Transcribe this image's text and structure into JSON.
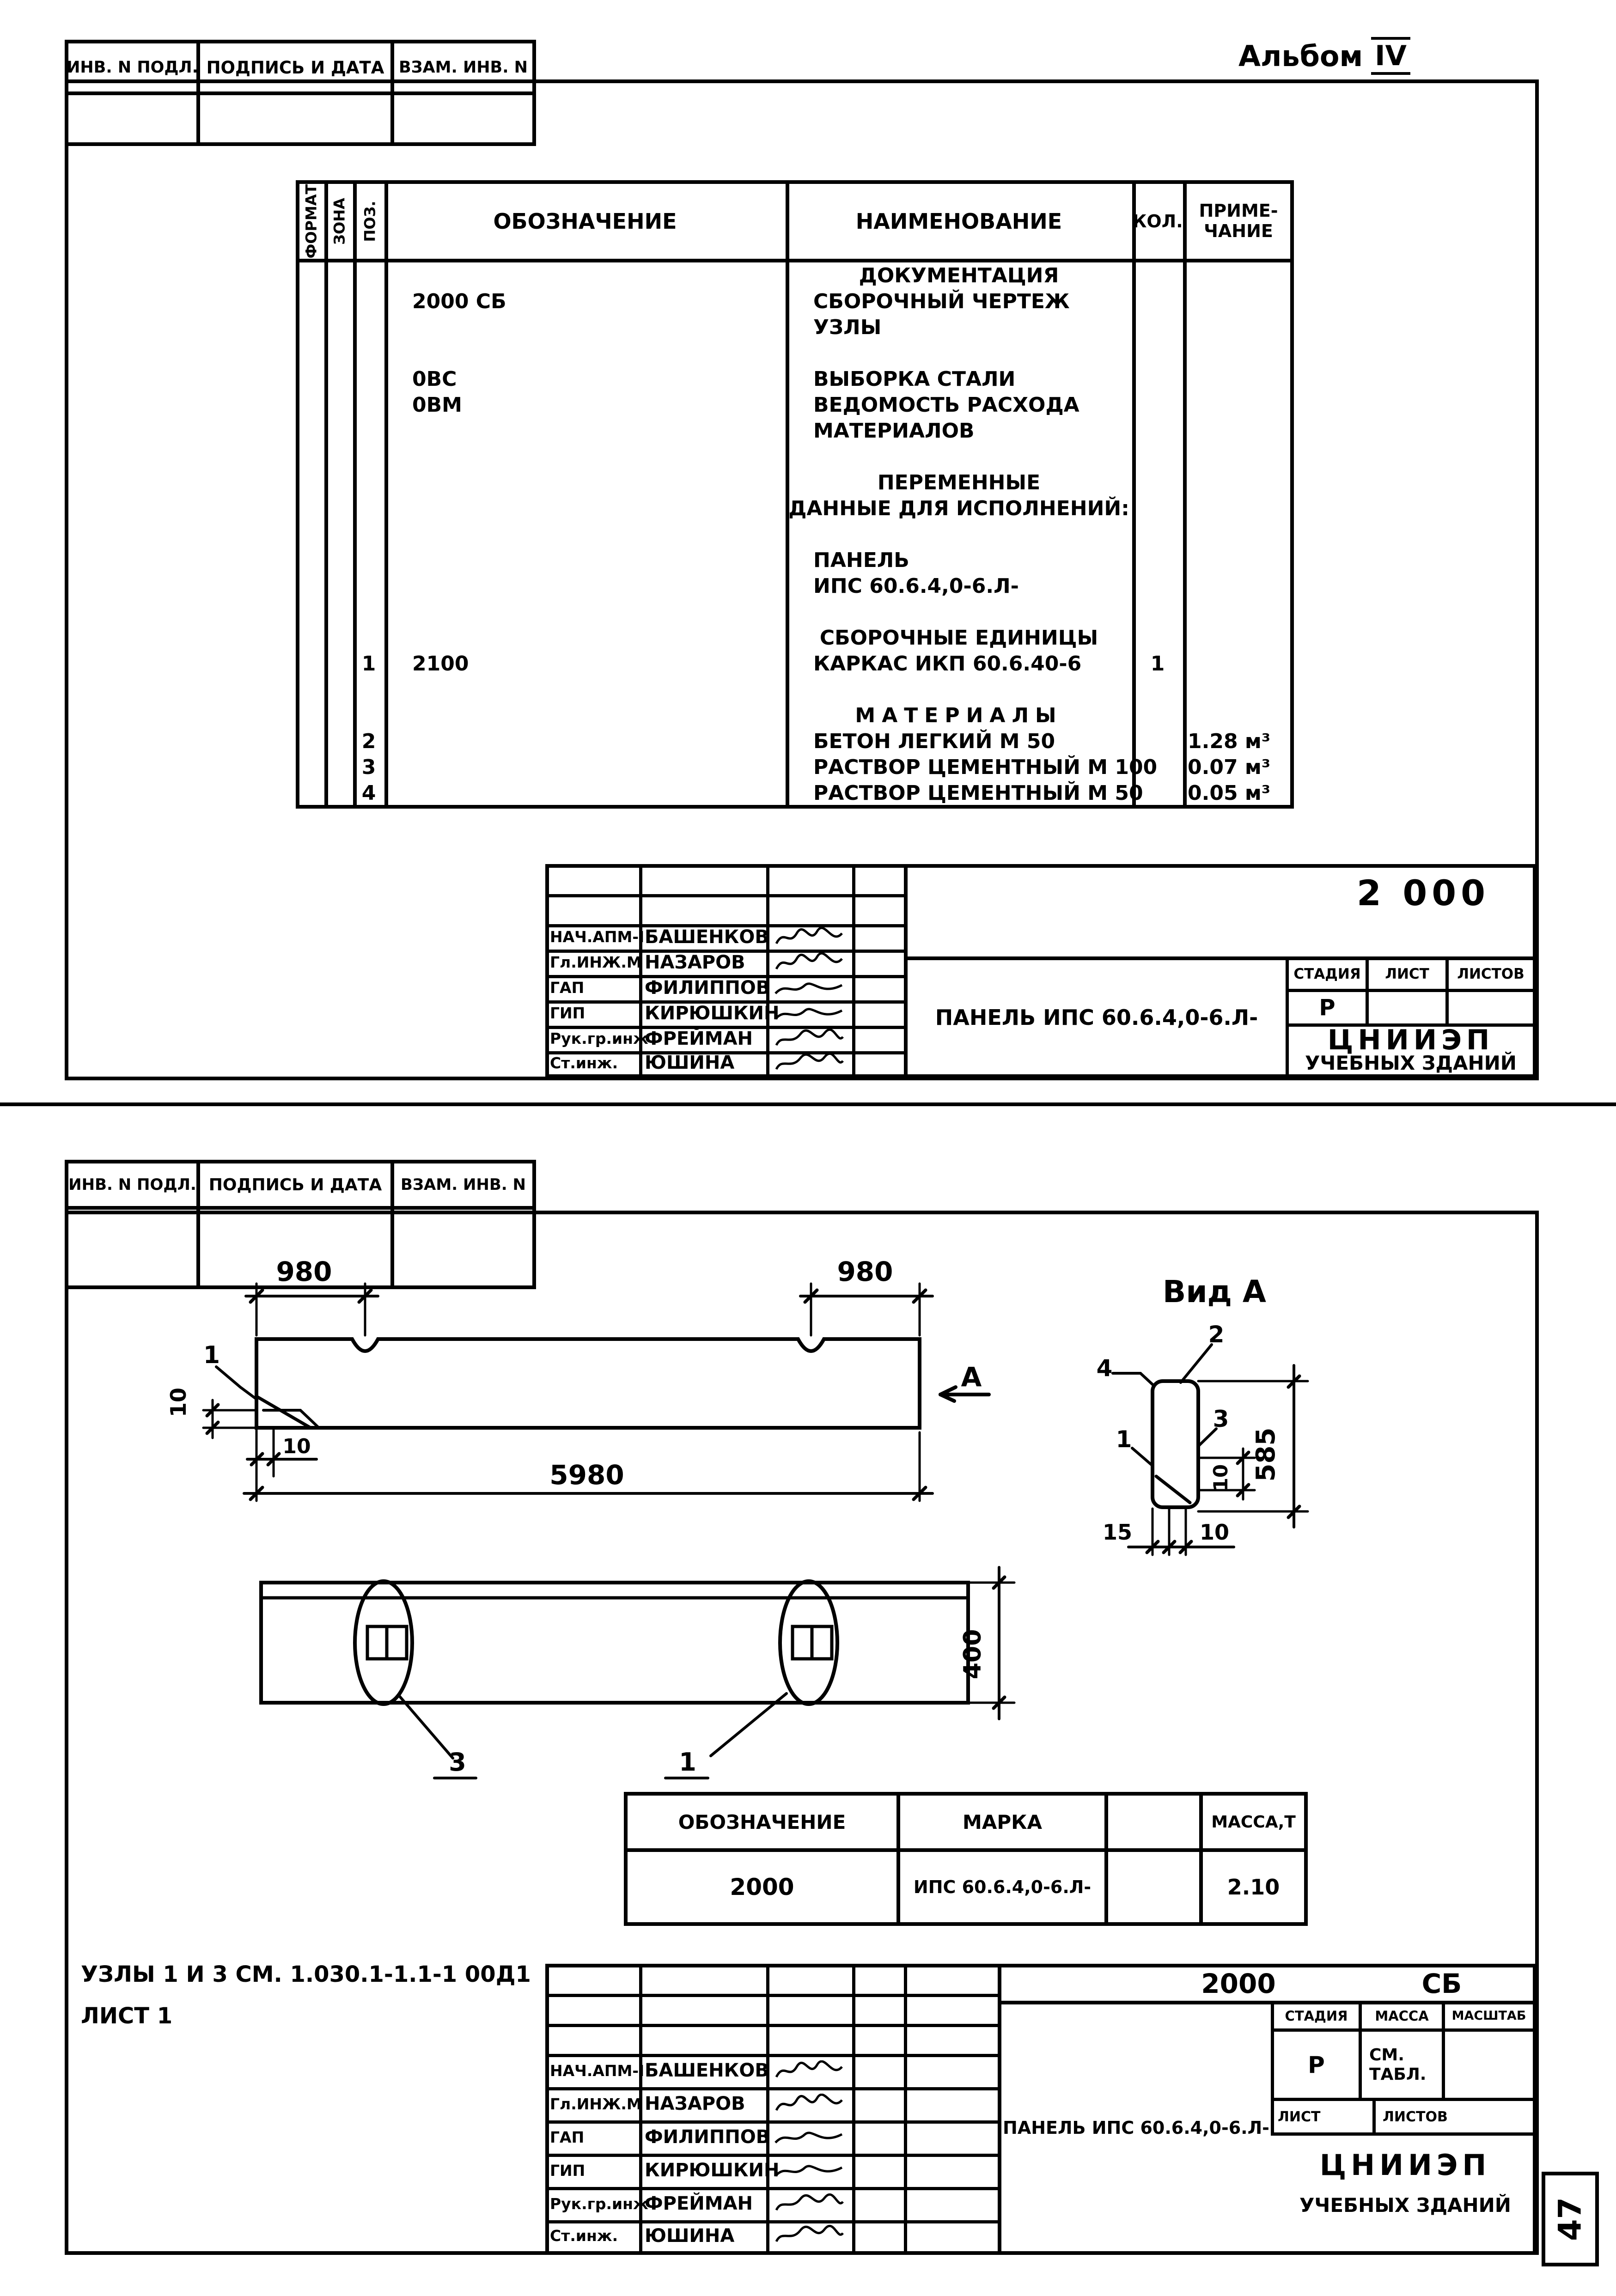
{
  "page": {
    "album_label": "Альбом",
    "album_number": "IV",
    "page_number": "47"
  },
  "margin_stamp": {
    "col1": "ИНВ. N ПОДЛ.",
    "col2": "ПОДПИСЬ И ДАТА",
    "col3": "ВЗАМ. ИНВ. N"
  },
  "spec_table": {
    "col_format": "ФОРМАТ",
    "col_zone": "ЗОНА",
    "col_pos": "ПОЗ.",
    "col_designation": "ОБОЗНАЧЕНИЕ",
    "col_name": "НАИМЕНОВАНИЕ",
    "col_qty": "КОЛ.",
    "col_note_1": "ПРИМЕ-",
    "col_note_2": "ЧАНИЕ",
    "rows": [
      {
        "name": "ДОКУМЕНТАЦИЯ"
      },
      {
        "designation": "2000 СБ",
        "name": "СБОРОЧНЫЙ ЧЕРТЕЖ"
      },
      {
        "name": "УЗЛЫ"
      },
      {},
      {
        "designation": "0ВС",
        "name": "ВЫБОРКА СТАЛИ"
      },
      {
        "designation": "0ВМ",
        "name": "ВЕДОМОСТЬ РАСХОДА"
      },
      {
        "name": "МАТЕРИАЛОВ"
      },
      {},
      {
        "name": "ПЕРЕМЕННЫЕ"
      },
      {
        "name": "ДАННЫЕ ДЛЯ ИСПОЛНЕНИЙ:"
      },
      {},
      {
        "name": "ПАНЕЛЬ"
      },
      {
        "name": "ИПС 60.6.4,0-6.Л-"
      },
      {},
      {
        "name": "СБОРОЧНЫЕ ЕДИНИЦЫ"
      },
      {
        "pos": "1",
        "designation": "2100",
        "name": "КАРКАС ИКП 60.6.40-6",
        "qty": "1"
      },
      {},
      {
        "name": "МАТЕРИАЛЫ"
      },
      {
        "pos": "2",
        "name": "БЕТОН ЛЕГКИЙ  М 50",
        "note": "1.28 м³"
      },
      {
        "pos": "3",
        "name": "РАСТВОР ЦЕМЕНТНЫЙ М 100",
        "note": "0.07 м³"
      },
      {
        "pos": "4",
        "name": "РАСТВОР ЦЕМЕНТНЫЙ М 50",
        "note": "0.05 м³"
      }
    ]
  },
  "signatories": [
    {
      "role": "НАЧ.АПМ-I",
      "name": "БАШЕНКОВ"
    },
    {
      "role": "Гл.ИНЖ.М",
      "name": "НАЗАРОВ"
    },
    {
      "role": "ГАП",
      "name": "ФИЛИППОВ"
    },
    {
      "role": "ГИП",
      "name": "КИРЮШКИН"
    },
    {
      "role": "Рук.гр.инж",
      "name": "ФРЕЙМАН"
    },
    {
      "role": "Ст.инж.",
      "name": "ЮШИНА"
    }
  ],
  "title_block_1": {
    "doc_number": "2 000",
    "title": "ПАНЕЛЬ ИПС 60.6.4,0-6.Л-",
    "stage_label": "СТАДИЯ",
    "sheet_label": "ЛИСТ",
    "sheets_label": "ЛИСТОВ",
    "stage_value": "Р",
    "org_line1": "ЦНИИЭП",
    "org_line2": "УЧЕБНЫХ ЗДАНИЙ"
  },
  "drawing": {
    "view_label": "Вид А",
    "section_label": "А",
    "dim_980_left": "980",
    "dim_980_right": "980",
    "dim_5980": "5980",
    "dim_10_left": "10",
    "dim_10_bottom": "10",
    "callout_elev_1": "1",
    "dim_585": "585",
    "dim_10_view": "10",
    "dim_15_view": "15",
    "dim_10_view_bottom": "10",
    "callout_view_1": "1",
    "callout_view_2": "2",
    "callout_view_3": "3",
    "callout_view_4": "4",
    "plan_callout_3": "3",
    "plan_callout_1": "1",
    "dim_400": "400"
  },
  "mark_table": {
    "col_designation": "ОБОЗНАЧЕНИЕ",
    "col_mark": "МАРКА",
    "col_mass": "МАССА,Т",
    "row": {
      "designation": "2000",
      "mark": "ИПС 60.6.4,0-6.Л-",
      "mass": "2.10"
    }
  },
  "note": {
    "line1": "УЗЛЫ 1 И 3 СМ. 1.030.1-1.1-1 00Д1",
    "line2": "ЛИСТ 1"
  },
  "title_block_2": {
    "doc_number": "2000",
    "doc_type": "СБ",
    "title": "ПАНЕЛЬ ИПС 60.6.4,0-6.Л-",
    "stage_label": "СТАДИЯ",
    "mass_label": "МАССА",
    "scale_label": "МАСШТАБ",
    "stage_value": "Р",
    "mass_value_1": "СМ.",
    "mass_value_2": "ТАБЛ.",
    "sheet_label": "ЛИСТ",
    "sheets_label": "ЛИСТОВ",
    "org_line1": "ЦНИИЭП",
    "org_line2": "УЧЕБНЫХ ЗДАНИЙ"
  }
}
